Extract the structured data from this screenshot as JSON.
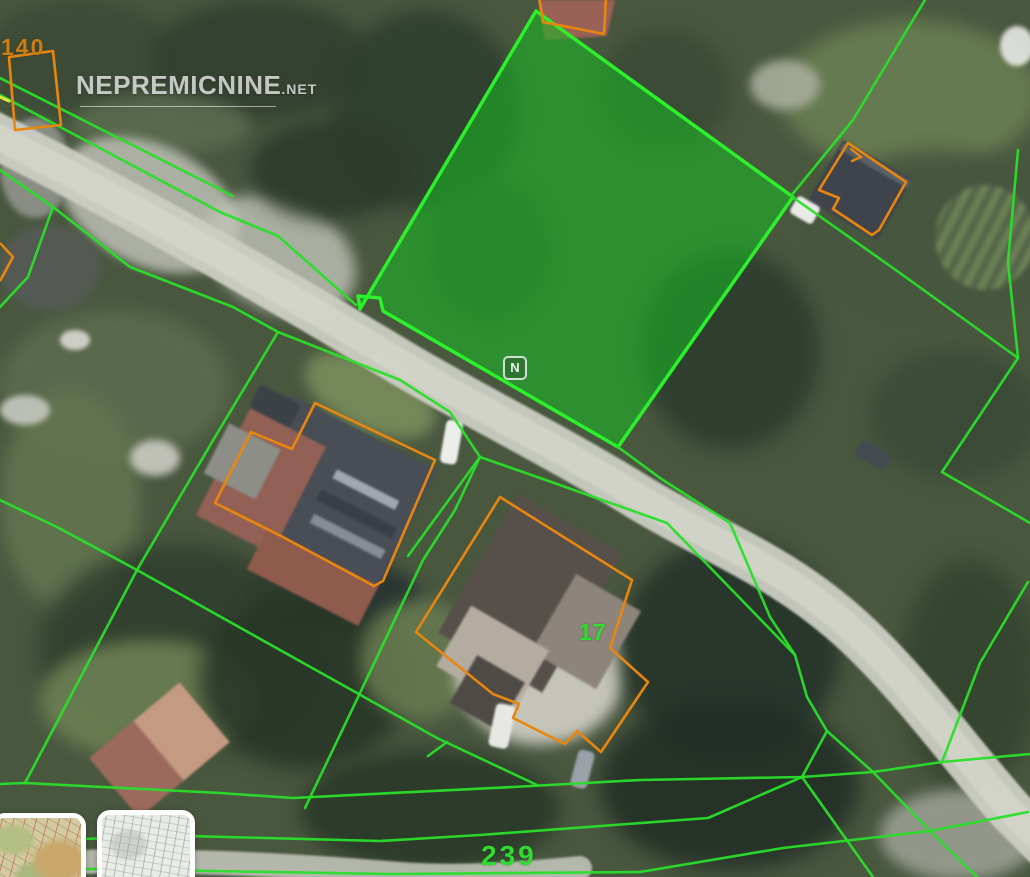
{
  "watermark": {
    "brand": "NEPREMICNINE",
    "tld": ".net",
    "center_badge": "N"
  },
  "labels": {
    "parcel_140": "140",
    "parcel_239": "239",
    "parcel_17": "17"
  },
  "colors": {
    "parcel_line": "#2ade2a",
    "parcel_fill": "rgba(22,190,34,0.55)",
    "parcel_stroke": "#2bf02b",
    "building_outline": "#e8860f",
    "label_green": "#30dc30",
    "label_orange": "#cd7c12",
    "road": "#cbcdc2",
    "road_core": "#d7d8cd",
    "yellow_mark": "#e6e635"
  },
  "thumbnails": [
    {
      "name": "terrain-map-thumbnail",
      "style": "topographic"
    },
    {
      "name": "road-map-thumbnail",
      "style": "grayscale"
    }
  ],
  "geometry": {
    "roads": [
      {
        "d": "M -12,132 C 140,208 280,290 400,362 C 470,404 560,448 640,498 C 720,546 780,565 850,628 C 910,682 965,760 1012,812 L 1045,845",
        "width": 46,
        "color": "#cbcdc2",
        "opacity": 0.95
      },
      {
        "d": "M -12,132 C 140,208 280,290 400,362 C 470,404 560,448 640,498 C 720,546 780,565 850,628 C 910,682 965,760 1012,812 L 1045,845",
        "width": 26,
        "color": "#d7d8cd",
        "opacity": 0.7
      },
      {
        "d": "M -10,866 C 140,856 280,864 400,874 C 470,879 540,872 580,868",
        "width": 24,
        "color": "#c7c8be",
        "opacity": 0.85
      }
    ],
    "highlighted_parcel": {
      "pts": [
        [
          536,
          11
        ],
        [
          793,
          197
        ],
        [
          618,
          447
        ],
        [
          383,
          311
        ],
        [
          380,
          298
        ],
        [
          358,
          296
        ],
        [
          360,
          309
        ]
      ]
    },
    "green_lines": [
      {
        "pts": [
          [
            0,
            78
          ],
          [
            233,
            196
          ]
        ]
      },
      {
        "pts": [
          [
            0,
            95
          ],
          [
            220,
            212
          ]
        ]
      },
      {
        "pts": [
          [
            0,
            170
          ],
          [
            53,
            207
          ]
        ]
      },
      {
        "pts": [
          [
            53,
            207
          ],
          [
            130,
            267
          ],
          [
            233,
            307
          ],
          [
            278,
            332
          ]
        ]
      },
      {
        "pts": [
          [
            53,
            207
          ],
          [
            28,
            277
          ],
          [
            0,
            307
          ]
        ]
      },
      {
        "pts": [
          [
            220,
            212
          ],
          [
            278,
            236
          ],
          [
            356,
            305
          ]
        ]
      },
      {
        "pts": [
          [
            278,
            332
          ],
          [
            400,
            380
          ],
          [
            450,
            412
          ],
          [
            480,
            457
          ],
          [
            540,
            478
          ],
          [
            667,
            523
          ],
          [
            795,
            655
          ],
          [
            807,
            697
          ],
          [
            827,
            731
          ],
          [
            873,
            772
          ],
          [
            930,
            831
          ],
          [
            977,
            877
          ]
        ]
      },
      {
        "pts": [
          [
            278,
            332
          ],
          [
            218,
            432
          ],
          [
            185,
            488
          ],
          [
            137,
            570
          ],
          [
            25,
            783
          ]
        ]
      },
      {
        "pts": [
          [
            618,
            447
          ],
          [
            660,
            478
          ],
          [
            730,
            523
          ],
          [
            770,
            617
          ],
          [
            795,
            655
          ]
        ]
      },
      {
        "pts": [
          [
            480,
            457
          ],
          [
            455,
            510
          ],
          [
            423,
            560
          ],
          [
            360,
            693
          ],
          [
            305,
            808
          ]
        ]
      },
      {
        "pts": [
          [
            0,
            500
          ],
          [
            57,
            527
          ],
          [
            137,
            570
          ],
          [
            280,
            650
          ],
          [
            357,
            693
          ],
          [
            437,
            738
          ],
          [
            537,
            785
          ]
        ]
      },
      {
        "pts": [
          [
            447,
            742
          ],
          [
            428,
            756
          ]
        ]
      },
      {
        "pts": [
          [
            480,
            457
          ],
          [
            408,
            556
          ]
        ]
      },
      {
        "pts": [
          [
            0,
            784
          ],
          [
            25,
            783
          ],
          [
            220,
            793
          ],
          [
            293,
            798
          ],
          [
            513,
            787
          ],
          [
            640,
            780
          ],
          [
            802,
            777
          ],
          [
            873,
            772
          ],
          [
            942,
            762
          ],
          [
            1030,
            754
          ]
        ]
      },
      {
        "pts": [
          [
            0,
            835
          ],
          [
            80,
            839
          ],
          [
            188,
            836
          ],
          [
            380,
            841
          ],
          [
            480,
            835
          ],
          [
            708,
            818
          ],
          [
            802,
            777
          ],
          [
            827,
            731
          ]
        ]
      },
      {
        "pts": [
          [
            0,
            868
          ],
          [
            90,
            869
          ],
          [
            390,
            874
          ],
          [
            640,
            872
          ],
          [
            783,
            848
          ],
          [
            930,
            831
          ],
          [
            1028,
            812
          ]
        ]
      },
      {
        "pts": [
          [
            802,
            777
          ],
          [
            873,
            877
          ]
        ]
      },
      {
        "pts": [
          [
            791,
            196
          ],
          [
            853,
            120
          ],
          [
            925,
            0
          ]
        ]
      },
      {
        "pts": [
          [
            791,
            196
          ],
          [
            900,
            273
          ],
          [
            1018,
            358
          ],
          [
            942,
            472
          ],
          [
            1030,
            523
          ]
        ]
      },
      {
        "pts": [
          [
            1018,
            358
          ],
          [
            1008,
            262
          ],
          [
            1018,
            150
          ]
        ]
      },
      {
        "pts": [
          [
            1028,
            582
          ],
          [
            980,
            663
          ],
          [
            942,
            762
          ]
        ]
      }
    ],
    "building_outlines": [
      {
        "pts": [
          [
            9,
            57
          ],
          [
            53,
            51
          ],
          [
            61,
            125
          ],
          [
            15,
            130
          ]
        ],
        "closed": true
      },
      {
        "pts": [
          [
            315,
            403
          ],
          [
            435,
            460
          ],
          [
            383,
            581
          ],
          [
            374,
            586
          ],
          [
            281,
            536
          ],
          [
            215,
            503
          ],
          [
            251,
            432
          ],
          [
            292,
            449
          ]
        ],
        "closed": true
      },
      {
        "pts": [
          [
            500,
            497
          ],
          [
            632,
            580
          ],
          [
            610,
            648
          ],
          [
            648,
            682
          ],
          [
            601,
            752
          ],
          [
            577,
            731
          ],
          [
            565,
            744
          ],
          [
            513,
            718
          ],
          [
            519,
            704
          ],
          [
            493,
            694
          ],
          [
            416,
            632
          ]
        ],
        "closed": true
      },
      {
        "pts": [
          [
            848,
            143
          ],
          [
            906,
            182
          ],
          [
            879,
            230
          ],
          [
            872,
            235
          ],
          [
            833,
            209
          ],
          [
            839,
            198
          ],
          [
            819,
            190
          ]
        ],
        "closed": true
      },
      {
        "pts": [
          [
            539,
            -4
          ],
          [
            543,
            22
          ],
          [
            604,
            34
          ],
          [
            606,
            -4
          ]
        ],
        "closed": false
      },
      {
        "pts": [
          [
            0,
            243
          ],
          [
            13,
            257
          ],
          [
            0,
            281
          ]
        ],
        "closed": false
      }
    ],
    "marks": [
      {
        "pts": [
          [
            0,
            97
          ],
          [
            9,
            101
          ]
        ],
        "color": "#e6e635",
        "width": 3
      },
      {
        "pts": [
          [
            851,
            149
          ],
          [
            861,
            157
          ],
          [
            852,
            161
          ]
        ],
        "color": "#e8860f",
        "width": 2.4
      }
    ]
  }
}
